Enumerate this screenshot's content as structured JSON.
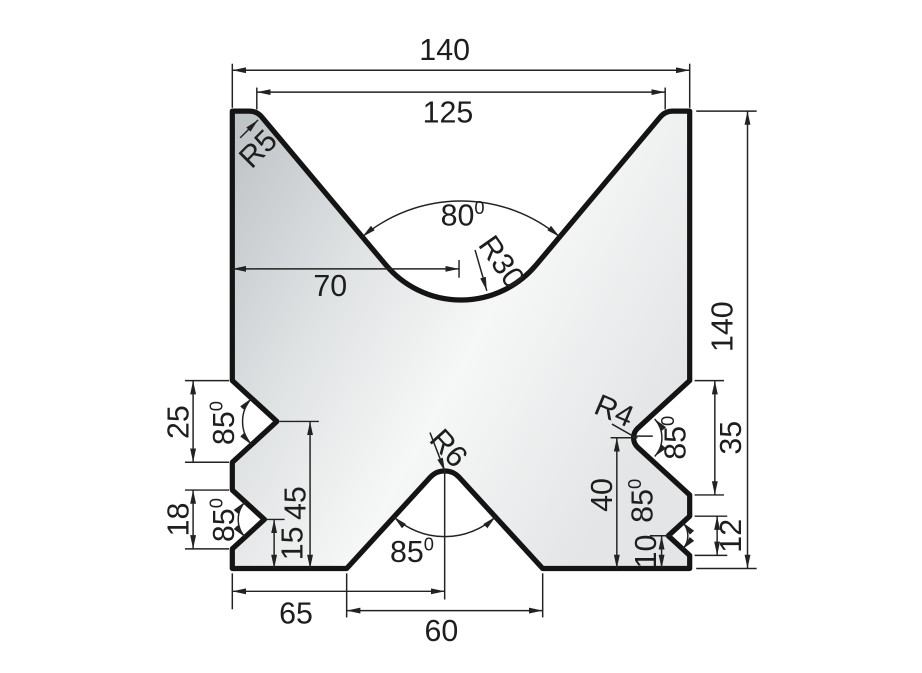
{
  "drawing": {
    "kind": "technical-drawing",
    "subject": "double-V press brake die block cross-section",
    "dims": {
      "top_width": "140",
      "top_v_opening": "125",
      "overall_height": "140",
      "top_v_center_from_left": "70",
      "left_upper_notch_opening": "25",
      "left_upper_notch_height": "45",
      "left_lower_notch_opening": "18",
      "left_lower_notch_height": "15",
      "bottom_v_center_from_left": "65",
      "bottom_v_opening": "60",
      "right_upper_notch_opening": "35",
      "right_upper_notch_height": "40",
      "right_lower_notch_opening": "12",
      "right_lower_notch_height": "10"
    },
    "angles": {
      "top_v": {
        "value": "80",
        "sup": "0"
      },
      "bottom_v": {
        "value": "85",
        "sup": "0"
      },
      "left_upper": {
        "value": "85",
        "sup": "0"
      },
      "left_lower": {
        "value": "85",
        "sup": "0"
      },
      "right_upper": {
        "value": "85",
        "sup": "0"
      },
      "right_lower": {
        "value": "85",
        "sup": "0"
      }
    },
    "radii": {
      "top_shoulder": "R5",
      "top_v_bottom": "R30",
      "bottom_v_tip": "R6",
      "right_upper_tip": "R4"
    },
    "colors": {
      "outline": "#141414",
      "dimension_lines": "#222222",
      "background": "#ffffff",
      "fill_dark": "#bcc1c4",
      "fill_mid": "#dfe2e3",
      "fill_light": "#f6f7f7",
      "fill_edge": "#e3e5e6"
    }
  }
}
